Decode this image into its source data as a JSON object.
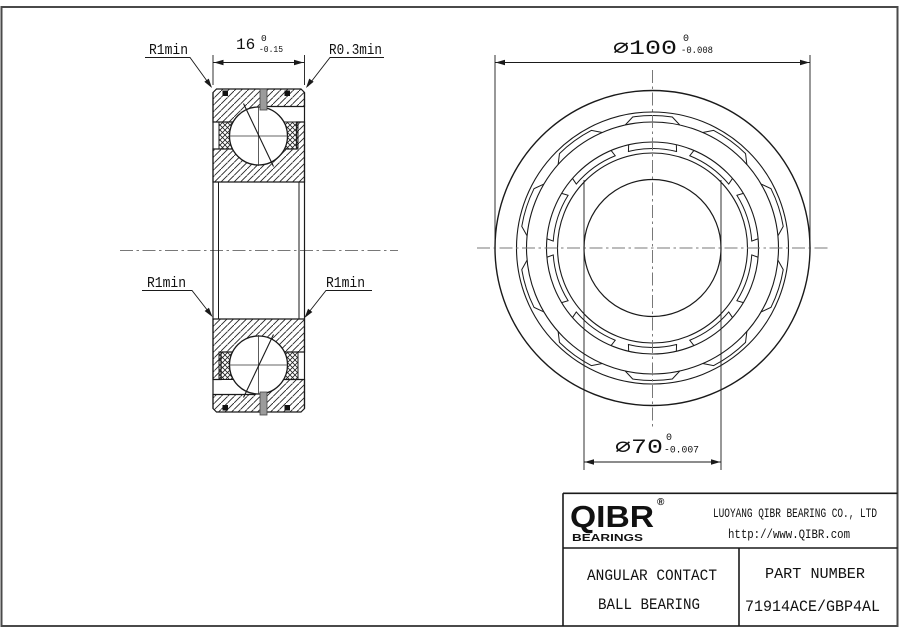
{
  "drawing": {
    "labels": {
      "radius_top_left": "R1min",
      "radius_top_right": "R0.3min",
      "radius_mid_left": "R1min",
      "radius_mid_right": "R1min"
    },
    "dimensions": {
      "width": {
        "value": "16",
        "tol_upper": "0",
        "tol_lower": "-0.15"
      },
      "outer_diameter": {
        "value": "∅100",
        "tol_upper": "0",
        "tol_lower": "-0.008"
      },
      "bore_diameter": {
        "value": "∅70",
        "tol_upper": "0",
        "tol_lower": "-0.007"
      }
    },
    "colors": {
      "line": "#1a1a1a",
      "centerline": "#787878",
      "hole_fill": "#9b9b9b"
    }
  },
  "title_block": {
    "logo": {
      "text": "QIBR",
      "registered": "®",
      "subtext": "BEARINGS"
    },
    "company": "LUOYANG QIBR BEARING CO., LTD",
    "website": "http://www.QIBR.com",
    "product_line1": "ANGULAR CONTACT",
    "product_line2": "BALL BEARING",
    "part_number_label": "PART NUMBER",
    "part_number": "71914ACE/GBP4AL"
  }
}
